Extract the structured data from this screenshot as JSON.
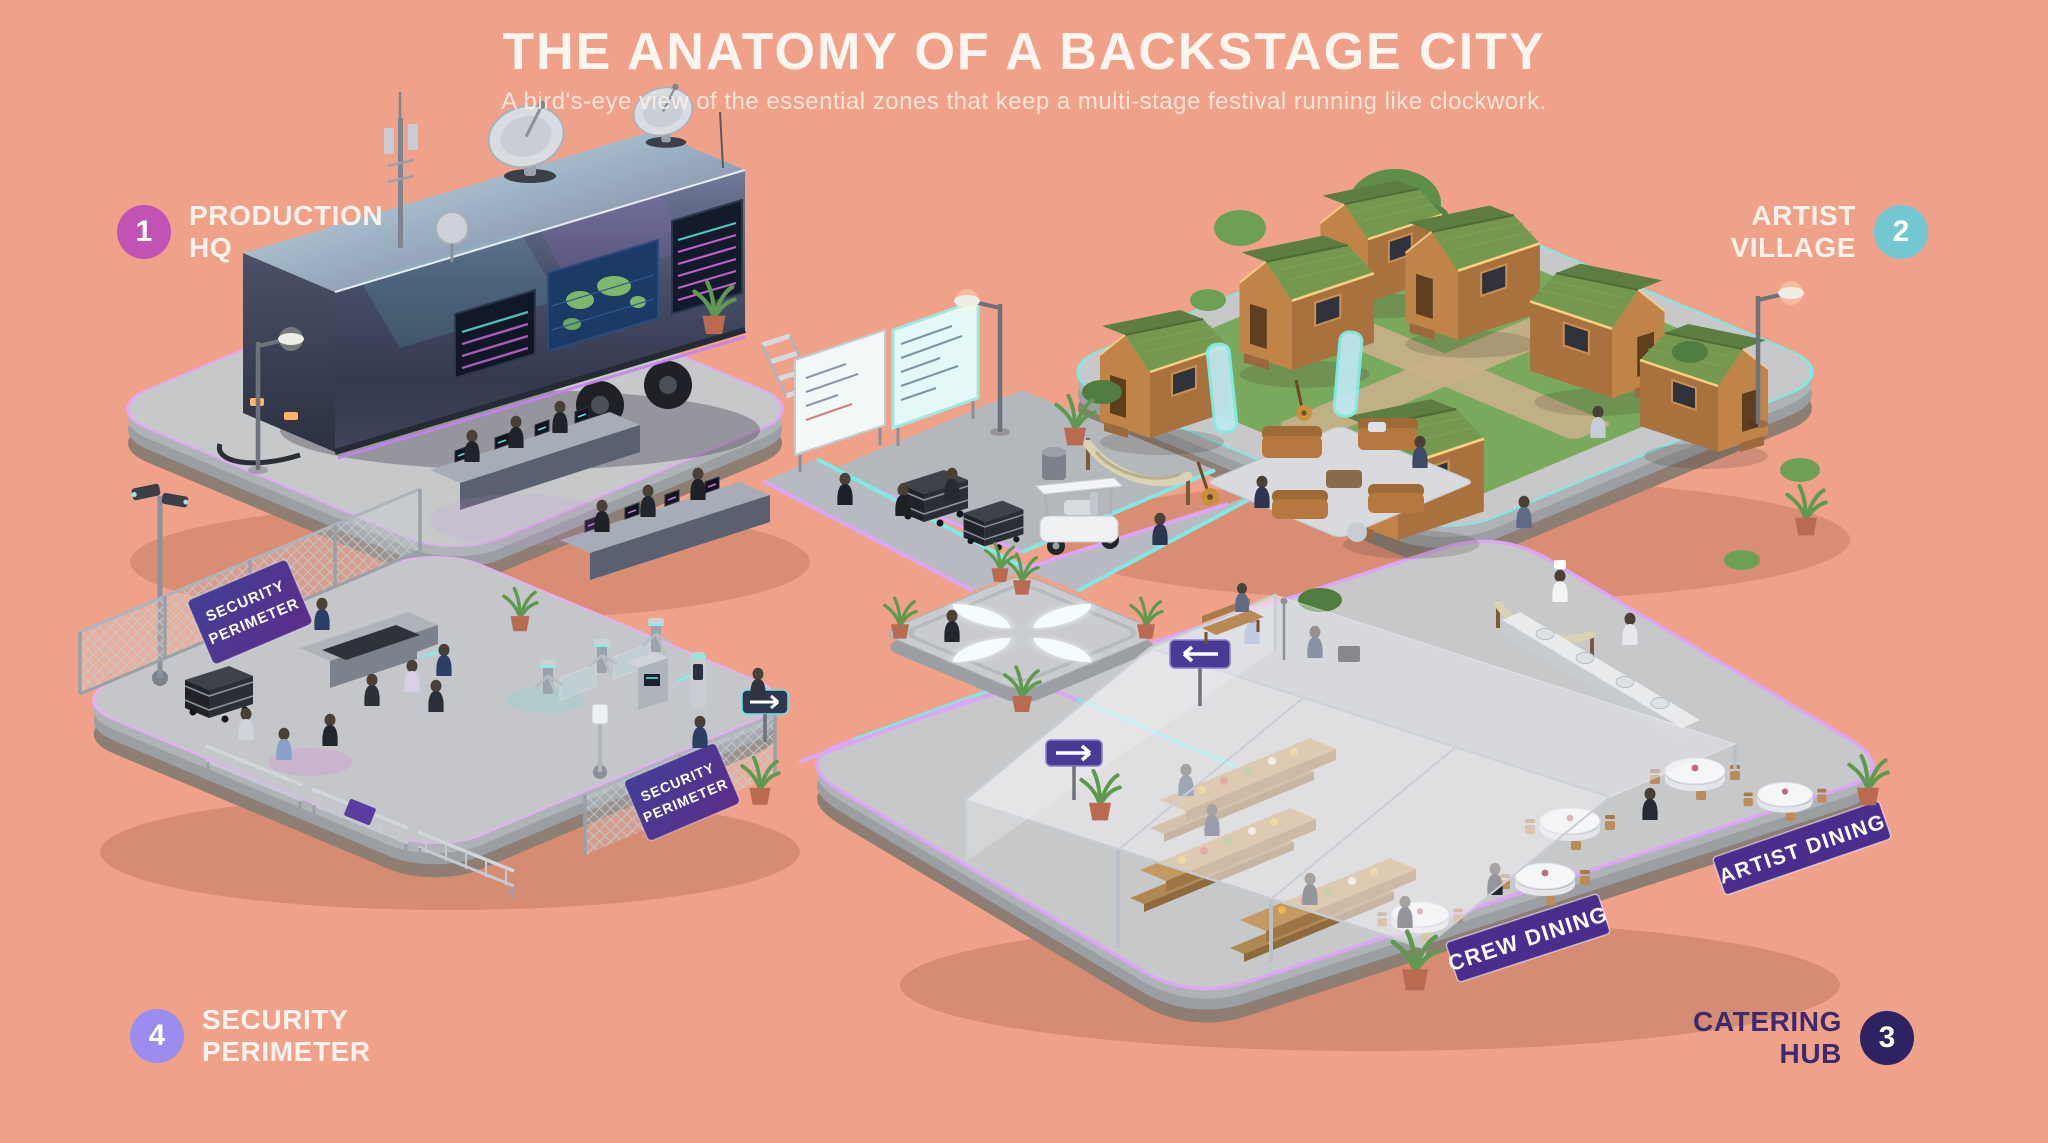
{
  "page": {
    "title": "THE ANATOMY OF A BACKSTAGE CITY",
    "subtitle": "A bird's-eye view of the essential zones that keep a multi-stage festival running like clockwork.",
    "background_color": "#efa289"
  },
  "zones": [
    {
      "id": "production-hq",
      "number": "1",
      "line1": "PRODUCTION",
      "line2": "HQ",
      "badge_color": "#c253b4",
      "text_color": "#fdf3ec"
    },
    {
      "id": "artist-village",
      "number": "2",
      "line1": "ARTIST",
      "line2": "VILLAGE",
      "badge_color": "#72c7d1",
      "text_color": "#fdf3ec"
    },
    {
      "id": "catering-hub",
      "number": "3",
      "line1": "CATERING",
      "line2": "HUB",
      "badge_color": "#2e2263",
      "text_color": "#3b2a70"
    },
    {
      "id": "security-perimeter",
      "number": "4",
      "line1": "SECURITY",
      "line2": "PERIMETER",
      "badge_color": "#9c8cf0",
      "text_color": "#fdf3ec"
    }
  ],
  "scene": {
    "signs": {
      "crew_dining": "CREW DINING",
      "artist_dining": "ARTIST DINING",
      "security_banner_line1": "SECURITY",
      "security_banner_line2": "PERIMETER"
    },
    "colors": {
      "neon_purple": "#dda6f5",
      "neon_cyan": "#7fe9e4",
      "platform_top": "#c5c7ca",
      "cabin_roof": "#73984e",
      "sign_purple": "#4a2d8c",
      "banner_purple": "#433f96"
    }
  }
}
